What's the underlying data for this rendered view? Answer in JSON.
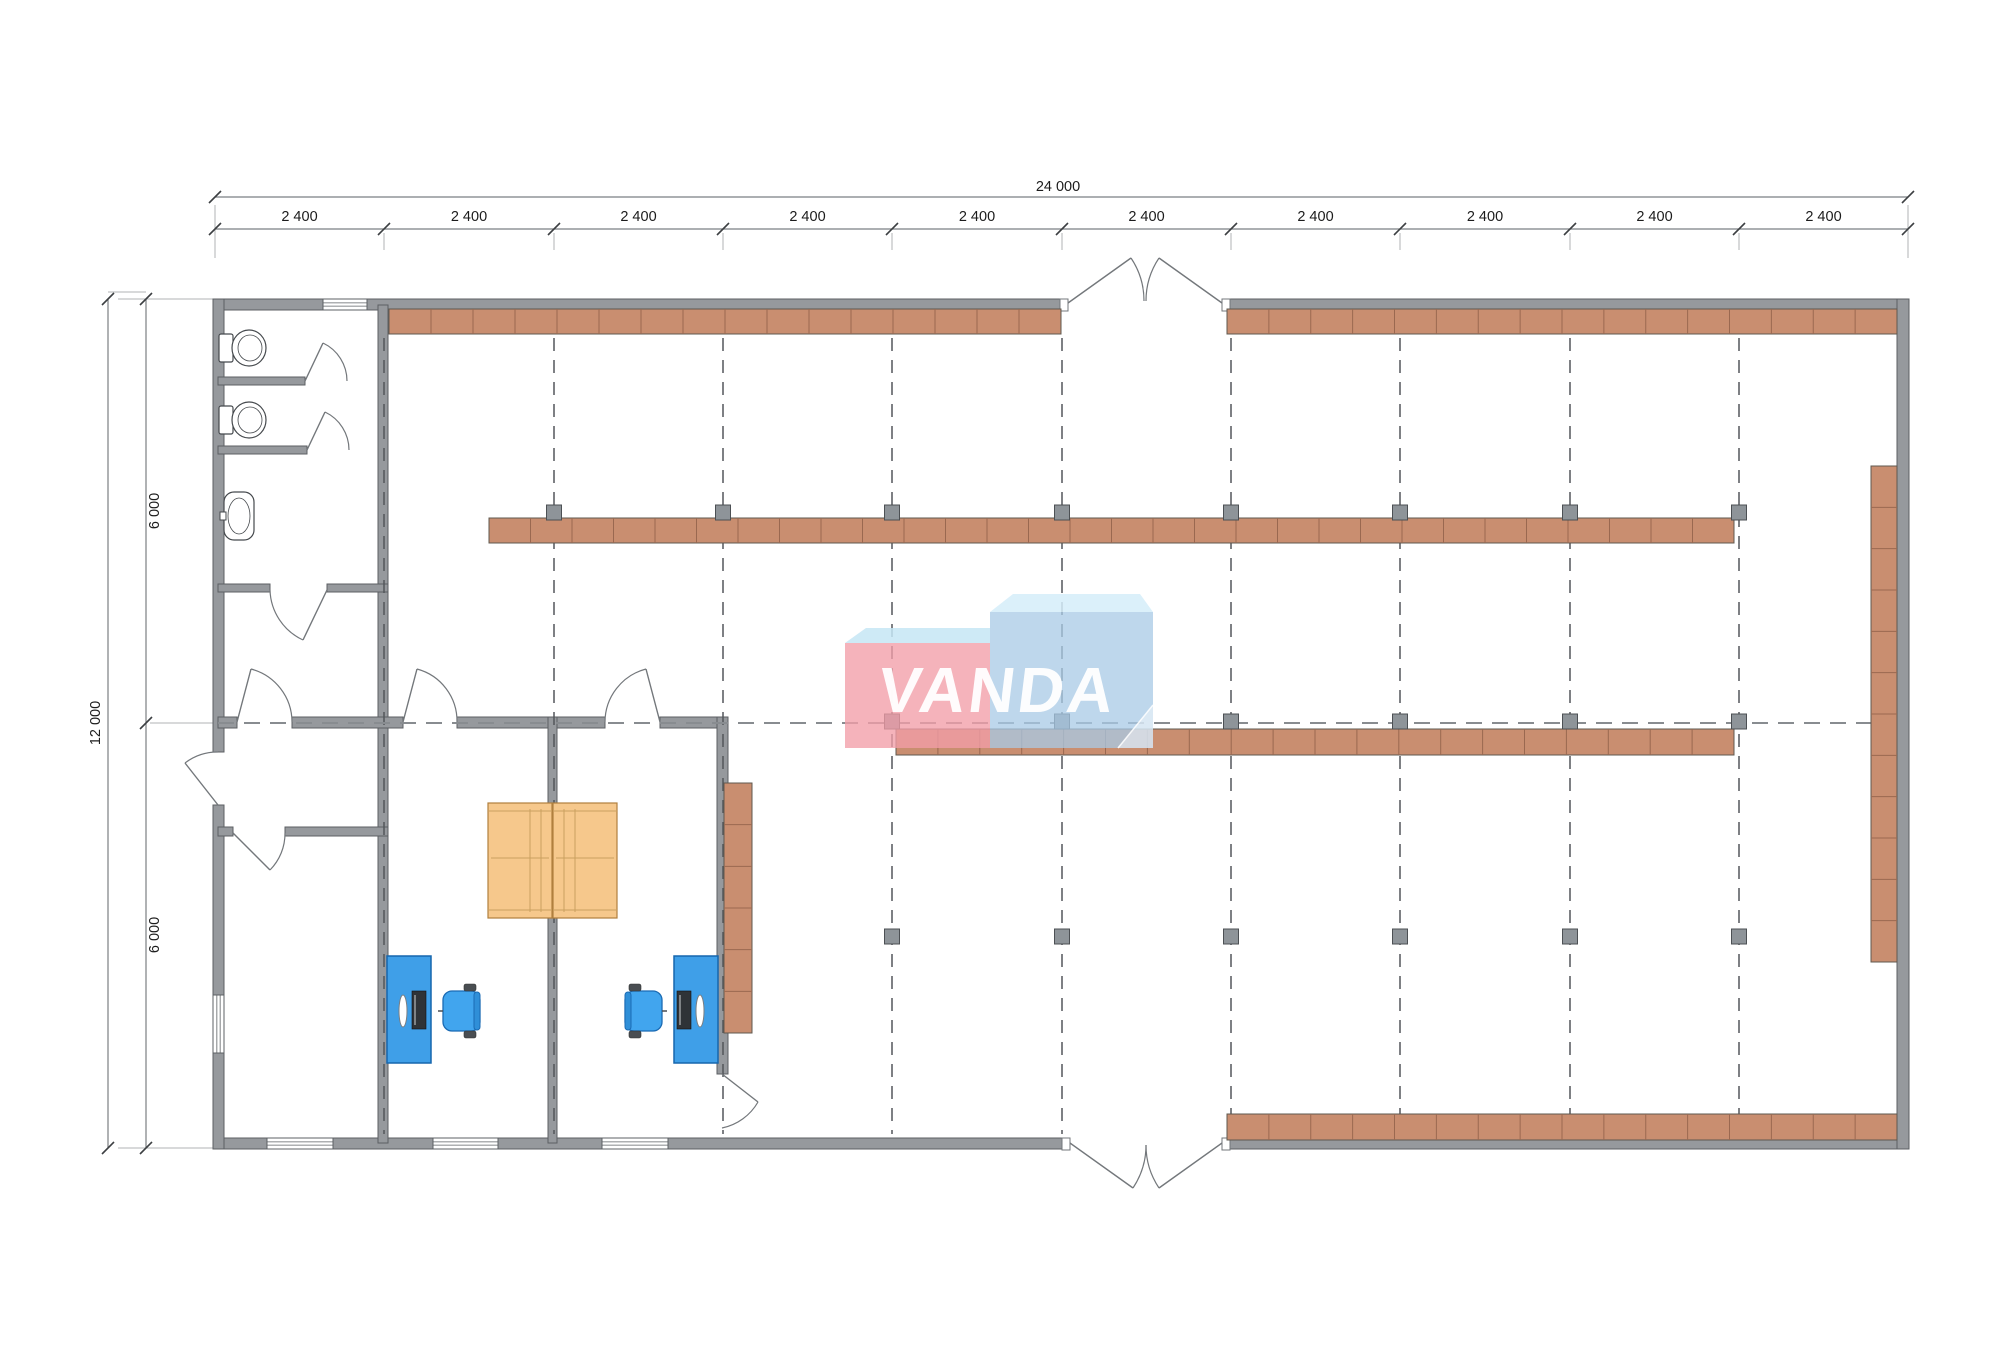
{
  "title": "warehouse-floor-plan",
  "plan": {
    "canvas": {
      "w": 2000,
      "h": 1358,
      "bg": "#ffffff"
    },
    "colors": {
      "wall_fill": "#96999d",
      "wall_stroke": "#5c5f63",
      "shelf_fill": "#c98e70",
      "shelf_stroke": "#5f584f",
      "shelf_div": "#9a6850",
      "column_fill": "#8e9499",
      "column_stroke": "#4c5054",
      "grid_v": "#53575b",
      "grid_h": "#888c90",
      "dim_line": "#7b7f83",
      "dim_tick": "#3c3f42",
      "dim_stub": "#b0b3b6",
      "door": "#73777b",
      "window_line": "#5c6064",
      "desk_fill": "#3f9fe8",
      "desk_stroke": "#1767ae",
      "chair_fill": "#41a5ee",
      "chair_stroke": "#1b6bb4",
      "chair_stub": "#4a4e52",
      "table_fill": "#f6c88c",
      "table_stroke": "#b07f3e",
      "table_line": "#caa05f",
      "fixture_stroke": "#45494d",
      "monitor": "#2f3337",
      "logo_pink": "rgba(242,158,168,0.78)",
      "logo_pink_top": "rgba(198,230,245,0.85)",
      "logo_blue": "rgba(168,202,230,0.75)",
      "logo_blue_top": "rgba(213,237,249,0.85)",
      "logo_fold": "rgba(255,255,255,0.45)"
    },
    "grid": {
      "xs": [
        384,
        554,
        723,
        892,
        1062,
        1231,
        1400,
        1570,
        1739
      ],
      "y_top": 338,
      "y_bottom": 1134,
      "mid_y": 723,
      "x_left": 218,
      "x_right": 1896
    },
    "walls": [
      [
        213,
        299,
        855,
        11
      ],
      [
        1222,
        299,
        687,
        11
      ],
      [
        213,
        1138,
        857,
        11
      ],
      [
        1222,
        1138,
        687,
        11
      ],
      [
        213,
        299,
        11,
        453
      ],
      [
        213,
        805,
        11,
        344
      ],
      [
        1897,
        299,
        12,
        850
      ],
      [
        378,
        305,
        10,
        838
      ],
      [
        218,
        377,
        87,
        8
      ],
      [
        218,
        446,
        89,
        8
      ],
      [
        218,
        584,
        52,
        8
      ],
      [
        327,
        584,
        61,
        8
      ],
      [
        218,
        717,
        19,
        11
      ],
      [
        292,
        717,
        111,
        11
      ],
      [
        457,
        717,
        148,
        11
      ],
      [
        660,
        717,
        68,
        11
      ],
      [
        548,
        717,
        9,
        426
      ],
      [
        717,
        717,
        11,
        357
      ],
      [
        218,
        827,
        15,
        9
      ],
      [
        285,
        827,
        103,
        9
      ]
    ],
    "windows": [
      [
        323,
        299,
        44,
        11,
        "h"
      ],
      [
        213,
        995,
        11,
        58,
        "v"
      ],
      [
        267,
        1138,
        66,
        11,
        "h"
      ],
      [
        433,
        1138,
        65,
        11,
        "h"
      ],
      [
        602,
        1138,
        66,
        11,
        "h"
      ]
    ],
    "door_caps": [
      [
        1060,
        299,
        8,
        12
      ],
      [
        1222,
        299,
        8,
        12
      ],
      [
        1062,
        1138,
        8,
        12
      ],
      [
        1222,
        1138,
        8,
        12
      ]
    ],
    "doors": [
      {
        "name": "stall-door-1",
        "leaf": [
          305,
          381,
          323,
          343
        ],
        "arc": [
          323,
          343,
          42,
          347,
          381,
          1
        ]
      },
      {
        "name": "stall-door-2",
        "leaf": [
          307,
          450,
          325,
          412
        ],
        "arc": [
          325,
          412,
          42,
          349,
          450,
          1
        ]
      },
      {
        "name": "bathroom-door",
        "leaf": [
          327,
          590,
          303,
          640
        ],
        "arc": [
          303,
          640,
          57,
          270,
          590,
          1
        ]
      },
      {
        "name": "corridor-door",
        "leaf": [
          237,
          722,
          251,
          669
        ],
        "arc": [
          251,
          669,
          55,
          292,
          722,
          1
        ]
      },
      {
        "name": "office-left-door",
        "leaf": [
          403,
          722,
          417,
          669
        ],
        "arc": [
          417,
          669,
          54,
          457,
          722,
          1
        ]
      },
      {
        "name": "office-right-door",
        "leaf": [
          660,
          722,
          646,
          669
        ],
        "arc": [
          646,
          669,
          55,
          605,
          722,
          0
        ]
      },
      {
        "name": "vestibule-door",
        "leaf": [
          233,
          833,
          270,
          870
        ],
        "arc": [
          270,
          870,
          52,
          285,
          833,
          0
        ]
      },
      {
        "name": "side-entrance-door",
        "leaf": [
          218,
          805,
          185,
          763
        ],
        "arc": [
          185,
          763,
          53,
          218,
          752,
          1
        ]
      },
      {
        "name": "office-east-door",
        "leaf": [
          722,
          1074,
          758,
          1102
        ],
        "arc": [
          758,
          1102,
          54,
          722,
          1128,
          1
        ]
      },
      {
        "name": "top-entrance-left",
        "leaf": [
          1068,
          303,
          1131,
          258
        ],
        "arc": [
          1131,
          258,
          77,
          1144,
          301,
          1
        ]
      },
      {
        "name": "top-entrance-right",
        "leaf": [
          1222,
          303,
          1159,
          258
        ],
        "arc": [
          1159,
          258,
          77,
          1146,
          301,
          0
        ]
      },
      {
        "name": "bottom-entrance-left",
        "leaf": [
          1070,
          1143,
          1133,
          1188
        ],
        "arc": [
          1133,
          1188,
          77,
          1146,
          1145,
          0
        ]
      },
      {
        "name": "bottom-entrance-right",
        "leaf": [
          1222,
          1143,
          1159,
          1188
        ],
        "arc": [
          1159,
          1188,
          77,
          1146,
          1145,
          1
        ]
      }
    ],
    "shelves": [
      {
        "r": [
          389,
          309,
          672,
          25
        ],
        "dir": "h"
      },
      {
        "r": [
          1227,
          309,
          670,
          25
        ],
        "dir": "h"
      },
      {
        "r": [
          489,
          518,
          1245,
          25
        ],
        "dir": "h"
      },
      {
        "r": [
          896,
          729,
          838,
          26
        ],
        "dir": "h"
      },
      {
        "r": [
          1227,
          1114,
          670,
          26
        ],
        "dir": "h"
      },
      {
        "r": [
          1871,
          466,
          26,
          496
        ],
        "dir": "v"
      },
      {
        "r": [
          724,
          783,
          28,
          250
        ],
        "dir": "v"
      }
    ],
    "shelf_segment": 41.6,
    "columns": [
      {
        "y": 505,
        "xs": [
          554,
          723,
          892,
          1062,
          1231,
          1400,
          1570,
          1739
        ]
      },
      {
        "y": 714,
        "xs": [
          892,
          1062,
          1231,
          1400,
          1570,
          1739
        ]
      },
      {
        "y": 929,
        "xs": [
          892,
          1062,
          1231,
          1400,
          1570,
          1739
        ]
      }
    ],
    "column_size": 15,
    "furniture": {
      "toilets": [
        {
          "tank": [
            219,
            334,
            14,
            28
          ],
          "bowl": [
            249,
            348,
            17,
            18
          ]
        },
        {
          "tank": [
            219,
            406,
            14,
            28
          ],
          "bowl": [
            249,
            420,
            17,
            18
          ]
        }
      ],
      "sink": {
        "body": [
          224,
          492,
          30,
          48
        ],
        "inner": [
          239,
          516,
          11,
          18
        ],
        "tap": [
          220,
          512,
          6,
          8
        ]
      },
      "tables": [
        {
          "rect": [
            488,
            803,
            64,
            115
          ],
          "vlines": [
            530,
            541
          ],
          "hline": 858
        },
        {
          "rect": [
            553,
            803,
            64,
            115
          ],
          "vlines": [
            564,
            575
          ],
          "hline": 858
        }
      ],
      "desks": [
        {
          "rect": [
            387,
            956,
            44,
            107
          ],
          "monitor": [
            412,
            991,
            14,
            38
          ],
          "kb": [
            399,
            995,
            8,
            32
          ]
        },
        {
          "rect": [
            674,
            956,
            44,
            107
          ],
          "monitor": [
            677,
            991,
            14,
            38
          ],
          "kb": [
            696,
            995,
            8,
            32
          ]
        }
      ],
      "chairs": [
        {
          "body": [
            443,
            991,
            37,
            40
          ],
          "back": "right"
        },
        {
          "body": [
            625,
            991,
            37,
            40
          ],
          "back": "left"
        }
      ]
    },
    "logo": {
      "text": "VANDA",
      "pink_top": [
        [
          845,
          643
        ],
        [
          866,
          628
        ],
        [
          990,
          628
        ],
        [
          990,
          643
        ]
      ],
      "pink_box": [
        845,
        643,
        145,
        105
      ],
      "blue_top": [
        [
          990,
          612
        ],
        [
          1013,
          594
        ],
        [
          1140,
          594
        ],
        [
          1153,
          612
        ]
      ],
      "blue_box": [
        990,
        612,
        163,
        136
      ],
      "fold": [
        [
          1153,
          705
        ],
        [
          1153,
          748
        ],
        [
          1118,
          748
        ]
      ],
      "text_pos": [
        995,
        712
      ]
    },
    "dims": {
      "overall_h": {
        "label": "24 000",
        "line": [
          215,
          197,
          1908,
          197
        ],
        "label_pos": [
          1058,
          191
        ]
      },
      "segments_h": {
        "label": "2 400",
        "y": 229,
        "label_y": 221,
        "ticks": [
          215,
          384,
          554,
          723,
          892,
          1062,
          1231,
          1400,
          1570,
          1739,
          1908
        ]
      },
      "overall_v": {
        "label": "12 000",
        "line": [
          108,
          299,
          108,
          1148
        ],
        "label_pos": [
          100,
          723
        ]
      },
      "segments_v": {
        "label": "6 000",
        "x": 146,
        "label_x": 153,
        "ticks": [
          299,
          723,
          1148
        ],
        "label_ys": [
          511,
          935
        ]
      },
      "ext_lines": [
        [
          215,
          205,
          215,
          258
        ],
        [
          1908,
          205,
          1908,
          258
        ],
        [
          118,
          299,
          213,
          299
        ],
        [
          150,
          723,
          213,
          723
        ],
        [
          118,
          1148,
          213,
          1148
        ],
        [
          108,
          292,
          146,
          292
        ]
      ]
    }
  }
}
